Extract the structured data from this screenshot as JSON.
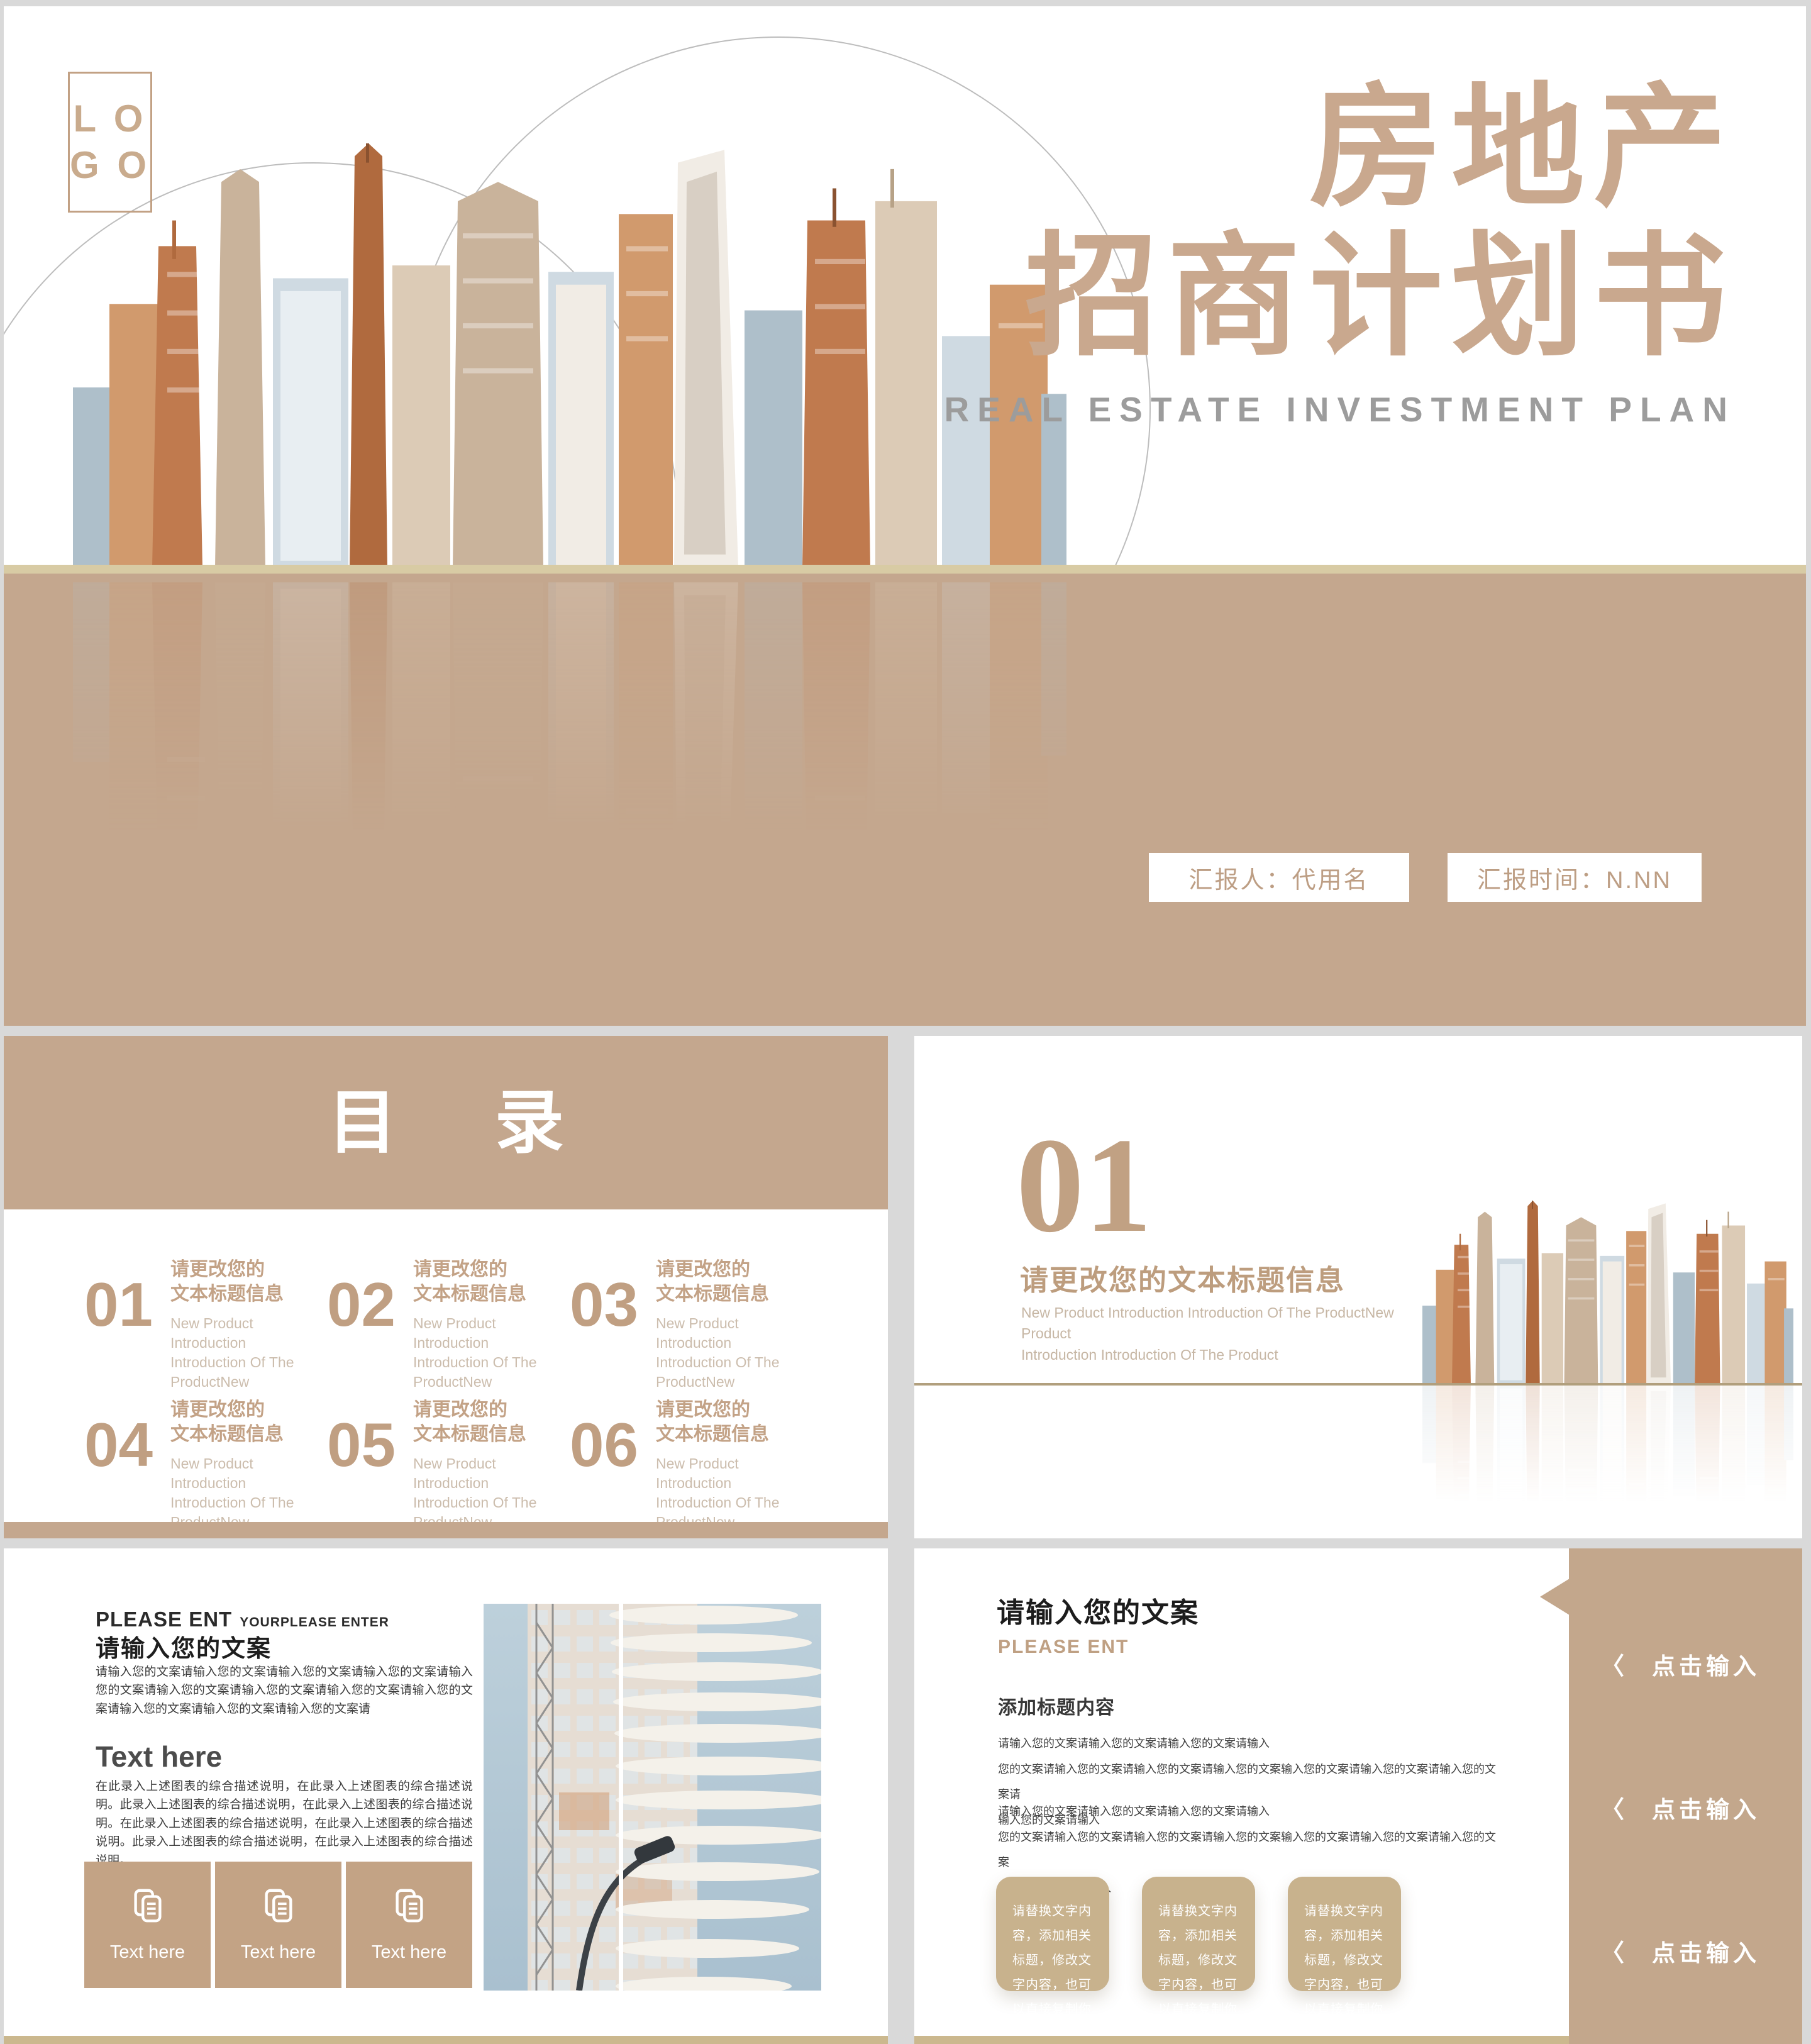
{
  "colors": {
    "band_tan": "#c4a78e",
    "title_tan": "#c9a88e",
    "gold_line": "#d8cba4",
    "khaki_strip": "#cbb88e",
    "card_tan": "#c3a385",
    "card_khaki": "#c8b28d",
    "subtitle_gray": "#9c9c9c",
    "section_line": "#b19f7d"
  },
  "cover": {
    "logo_line1": "L O",
    "logo_line2": "G O",
    "title_line1": "房地产",
    "title_line2": "招商计划书",
    "subtitle": "REAL ESTATE INVESTMENT PLAN",
    "presenter_badge": "汇报人：代用名",
    "date_badge": "汇报时间：N.NN"
  },
  "toc": {
    "header": "目 录",
    "items": [
      {
        "num": "01",
        "title_line1": "请更改您的",
        "title_line2": "文本标题信息",
        "desc": "New Product Introduction Introduction Of The ProductNew"
      },
      {
        "num": "02",
        "title_line1": "请更改您的",
        "title_line2": "文本标题信息",
        "desc": "New Product Introduction Introduction Of The ProductNew"
      },
      {
        "num": "03",
        "title_line1": "请更改您的",
        "title_line2": "文本标题信息",
        "desc": "New Product Introduction Introduction Of The ProductNew"
      },
      {
        "num": "04",
        "title_line1": "请更改您的",
        "title_line2": "文本标题信息",
        "desc": "New Product Introduction Introduction Of The ProductNew"
      },
      {
        "num": "05",
        "title_line1": "请更改您的",
        "title_line2": "文本标题信息",
        "desc": "New Product Introduction Introduction Of The ProductNew"
      },
      {
        "num": "06",
        "title_line1": "请更改您的",
        "title_line2": "文本标题信息",
        "desc": "New Product Introduction Introduction Of The ProductNew"
      }
    ]
  },
  "section": {
    "number": "01",
    "title": "请更改您的文本标题信息",
    "subtitle_line1": "New Product Introduction Introduction Of The ProductNew Product",
    "subtitle_line2": "Introduction Introduction Of The Product"
  },
  "detail": {
    "kicker": "PLEASE ENT",
    "kicker_suffix": "YOURPLEASE ENTER",
    "title": "请输入您的文案",
    "para1": "请输入您的文案请输入您的文案请输入您的文案请输入您的文案请输入您的文案请输入您的文案请输入您的文案请输入您的文案请输入您的文案请输入您的文案请输入您的文案请输入您的文案请",
    "subheading": "Text here",
    "para2": "在此录入上述图表的综合描述说明，在此录入上述图表的综合描述说明。此录入上述图表的综合描述说明，在此录入上述图表的综合描述说明。在此录入上述图表的综合描述说明，在此录入上述图表的综合描述说明。此录入上述图表的综合描述说明，在此录入上述图表的综合描述说明。",
    "cards": [
      {
        "label": "Text here"
      },
      {
        "label": "Text here"
      },
      {
        "label": "Text here"
      }
    ]
  },
  "content": {
    "title": "请输入您的文案",
    "kicker": "PLEASE ENT",
    "subheading": "添加标题内容",
    "para1_lines": [
      "请输入您的文案请输入您的文案请输入您的文案请输入",
      "您的文案请输入您的文案请输入您的文案请输入您的文案输入您的文案请输入您的文案请输入您的文案请",
      "输入您的文案请输入"
    ],
    "para2_lines": [
      "请输入您的文案请输入您的文案请输入您的文案请输入",
      "您的文案请输入您的文案请输入您的文案请输入您的文案输入您的文案请输入您的文案请输入您的文案",
      "请输入您的文案请输入"
    ],
    "cards": [
      {
        "text": "请替换文字内容，添加相关标题，修改文字内容，也可以直接复制你的内容到此。"
      },
      {
        "text": "请替换文字内容，添加相关标题，修改文字内容，也可以直接复制你的内容到此。"
      },
      {
        "text": "请替换文字内容，添加相关标题，修改文字内容，也可以直接复制你的内容到此。"
      }
    ],
    "sidebar_items": [
      {
        "label": "点击输入"
      },
      {
        "label": "点击输入"
      },
      {
        "label": "点击输入"
      }
    ]
  },
  "icons": {
    "chevron_left": "〈"
  }
}
